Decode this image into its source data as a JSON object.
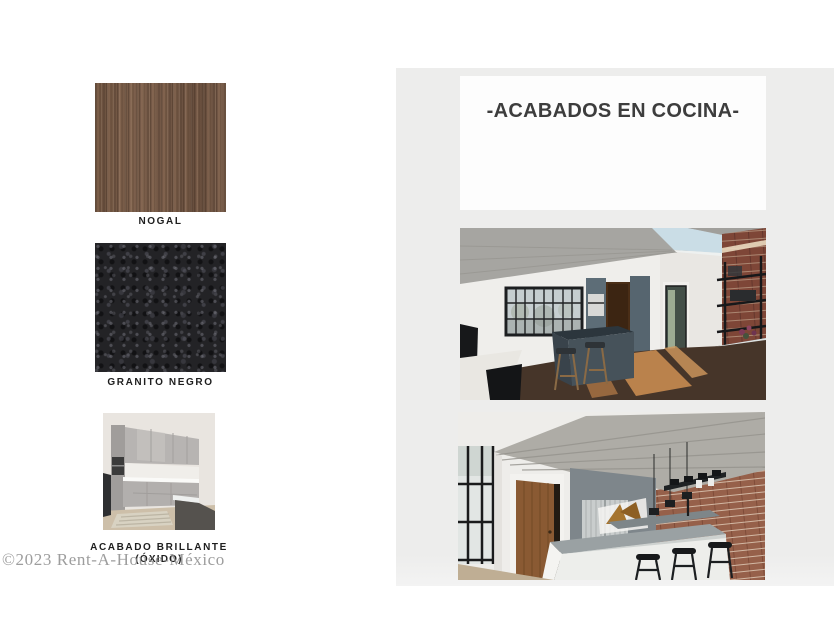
{
  "title": "-ACABADOS EN COCINA-",
  "materials": [
    {
      "label": "NOGAL"
    },
    {
      "label": "GRANITO NEGRO"
    },
    {
      "label": "ACABADO BRILLANTE",
      "sublabel": "(ÓXIDO)"
    }
  ],
  "renders": [
    {
      "alt": "Render de cocina estilo loft: plafón de concreto con tragaluz, ventana de acero, gabinetes altos gris azulado, isla con bancos de madera, piso de madera con luz de sol, muro de ladrillo con estantería metálica negra"
    },
    {
      "alt": "Render de cocina estilo loft: techo inclinado de concreto, ventana de acero, puerta de madera, muro gris con refrigerador de acero, isla blanca con cubierta gris y bancos negros, lámparas colgantes, muro de ladrillo"
    }
  ],
  "watermark": "©2023 Rent-A-House-México",
  "colors": {
    "page_background": "#ffffff",
    "panel_background": "#ededec",
    "card_background": "#fdfdfd",
    "title_text": "#3d3d3d",
    "label_text": "#1e1e1e",
    "watermark_text": "#8c8c8c",
    "walnut_brown": "#7b5f4d",
    "granite_black": "#232326",
    "brick_red": "#7e4637",
    "concrete_gray": "#a6a5a1"
  }
}
